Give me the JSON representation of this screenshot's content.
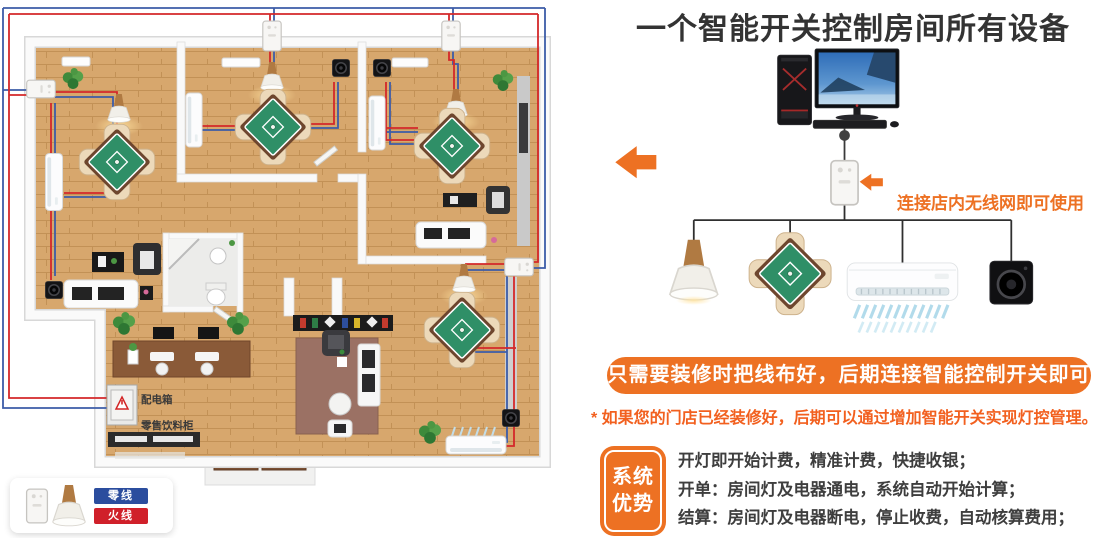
{
  "title": "一个智能开关控制房间所有设备",
  "right_panel": {
    "wifi_note": "连接店内无线网即可使用",
    "banner": "只需要装修时把线布好，后期连接智能控制开关即可",
    "footnote": "* 如果您的门店已经装修好，后期可以通过增加智能开关实现灯控管理。",
    "badge": {
      "line1": "系统",
      "line2": "优势"
    },
    "benefits": [
      "开灯即开始计费，精准计费，快捷收银；",
      "开单：房间灯及电器通电，系统自动开始计算；",
      "结算：房间灯及电器断电，停止收费，自动核算费用；"
    ]
  },
  "floorplan": {
    "distribution_box_label": "配电箱",
    "drink_cabinet_label": "零售饮料柜"
  },
  "legend": {
    "neutral_wire_label": "零线",
    "live_wire_label": "火线"
  },
  "colors": {
    "accent_orange": "#ed7123",
    "footnote_orange": "#f2601f",
    "wire_red": "#d4282a",
    "wire_blue": "#3c5ca8",
    "neutral_chip_blue": "#2b4d9e",
    "live_chip_red": "#d0202a",
    "title_text": "#333333",
    "body_text": "#3e3e3e"
  },
  "icons": {
    "desktop_computer": "pc-tower-monitor-keyboard",
    "smart_switch": "white-wall-switch",
    "pendant_lamp": "cone-shade-lamp",
    "mahjong_table": "green-table-four-chairs",
    "air_conditioner": "wall-ac-unit",
    "speaker": "black-subwoofer",
    "arrow_left": "orange-block-arrow",
    "distribution_box": "electric-box-with-warning",
    "plant": "potted-plant"
  }
}
